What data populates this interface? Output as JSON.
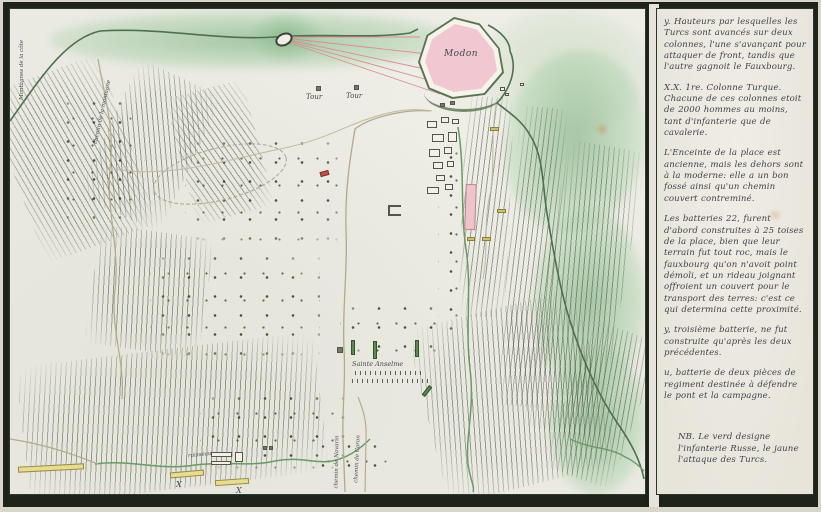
{
  "colors": {
    "paper": "#eaeae2",
    "frame_dark": "#1e2419",
    "sea_wash_green": "#8fbd92",
    "fortress_pink": "#f1c8d1",
    "rampart_green": "#5a7351",
    "turk_yellow": "#e7dc92",
    "russian_green": "#5d8a52",
    "fire_line_pink": "#d98f93",
    "ink": "#41434e"
  },
  "map": {
    "labels": {
      "fortress": "Modon",
      "tour_left": "Tour",
      "tour_right": "Tour",
      "church": "Sainte Anselme",
      "column_left": "X",
      "column_right": "X",
      "road_navarin": "chemin de Navarin",
      "road_coron": "chemin de Coron",
      "road_mountain": "chemin de la montagne",
      "stream": "ruisseau",
      "coast_mountains": "Montagnes de la côte"
    }
  },
  "panel": {
    "paragraphs": [
      "y. Hauteurs par lesquelles les Turcs sont avancés sur deux colonnes, l'une s'avançant pour attaquer de front, tandis que l'autre gagnoit le Fauxbourg.",
      "X.X. 1re. Colonne Turque. Chacune de ces colonnes etoit de 2000 hommes au moins, tant d'infanterie que de cavalerie.",
      "L'Enceinte de la place est ancienne, mais les dehors sont à la moderne: elle a un bon fossé ainsi qu'un chemin couvert contreminé.",
      "Les batteries 22, furent d'abord construites à 25 toises de la place, bien que leur terrain fut tout roc, mais le fauxbourg qu'on n'avoit point démoli, et un rideau joignant offroient un couvert pour le transport des terres: c'est ce qui determina cette proximité.",
      "y, troisième batterie, ne fut construite qu'après les deux précédentes.",
      "u, batterie de deux pièces de regiment destinée à défendre le pont et la campagne.",
      "NB. Le verd designe l'infanterie Russe, le jaune l'attaque des Turcs."
    ]
  }
}
